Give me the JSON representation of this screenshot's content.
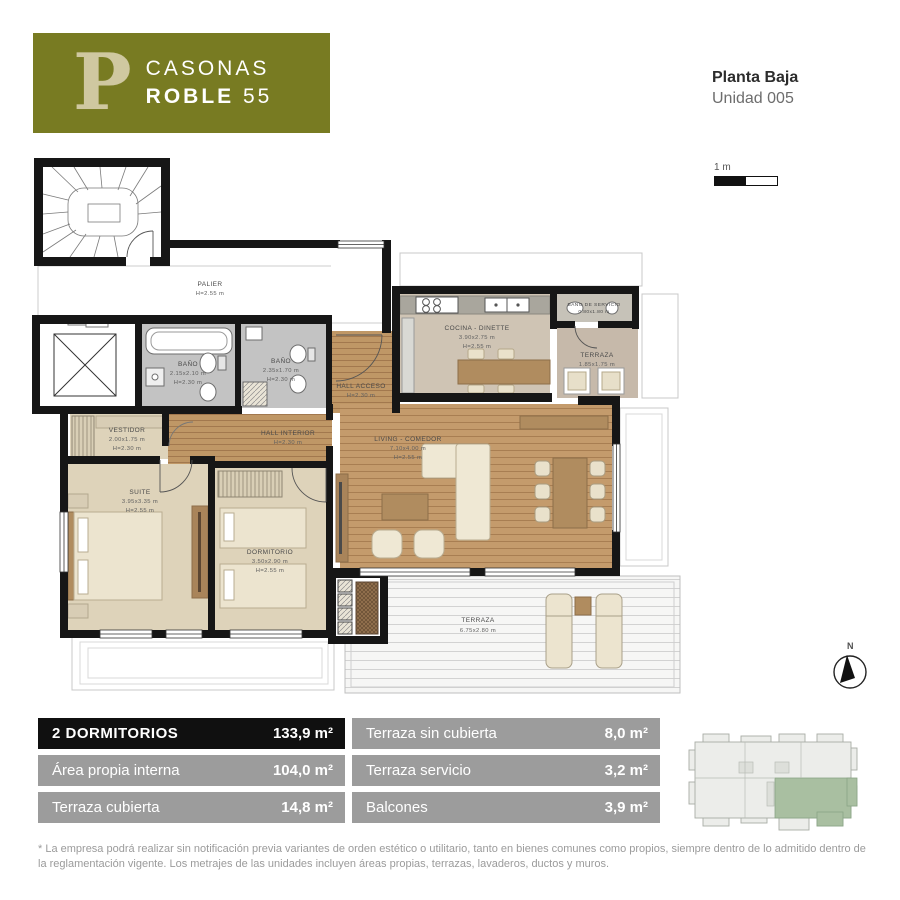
{
  "header": {
    "logo_letter": "P",
    "brand_line1": "CASONAS",
    "brand_bold": "ROBLE",
    "brand_num": "55",
    "plan_title": "Planta Baja",
    "plan_subtitle": "Unidad 005"
  },
  "scale_bar": {
    "label": "1 m"
  },
  "north": {
    "label": "N"
  },
  "floorplan": {
    "rooms": {
      "palier": {
        "name": "PALIER",
        "h": "H=2.55 m"
      },
      "banio1": {
        "name": "BAÑO",
        "dims": "2.15x2.10 m",
        "h": "H=2.30 m"
      },
      "banio2": {
        "name": "BAÑO",
        "dims": "2.35x1.70 m",
        "h": "H=2.30 m"
      },
      "hall_acceso": {
        "name": "HALL ACCESO",
        "h": "H=2.30 m"
      },
      "cocina": {
        "name": "COCINA - DINETTE",
        "dims": "3.90x2.75 m",
        "h": "H=2.55 m"
      },
      "banio_servicio": {
        "name": "BAÑO DE SERVICIO",
        "dims": "0.80x1.80 m"
      },
      "terraza_servicio": {
        "name": "TERRAZA",
        "dims": "1.85x1.75 m"
      },
      "vestidor": {
        "name": "VESTIDOR",
        "dims": "2.00x1.75 m",
        "h": "H=2.30 m"
      },
      "hall_interior": {
        "name": "HALL INTERIOR",
        "h": "H=2.30 m"
      },
      "suite": {
        "name": "SUITE",
        "dims": "3.95x3.35 m",
        "h": "H=2.55 m"
      },
      "dormitorio": {
        "name": "DORMITORIO",
        "dims": "3.50x2.90 m",
        "h": "H=2.55 m"
      },
      "living": {
        "name": "LIVING - COMEDOR",
        "dims": "7.10x4.00 m",
        "h": "H=2.55 m"
      },
      "terraza": {
        "name": "TERRAZA",
        "dims": "6.75x2.80 m"
      }
    }
  },
  "area_table": {
    "left": [
      {
        "label": "2 DORMITORIOS",
        "value": "133,9 m²"
      },
      {
        "label": "Área propia interna",
        "value": "104,0 m²"
      },
      {
        "label": "Terraza cubierta",
        "value": "14,8 m²"
      }
    ],
    "right": [
      {
        "label": "Terraza sin cubierta",
        "value": "8,0 m²"
      },
      {
        "label": "Terraza servicio",
        "value": "3,2 m²"
      },
      {
        "label": "Balcones",
        "value": "3,9 m²"
      }
    ]
  },
  "footnote": "* La empresa podrá realizar sin notificación previa variantes de orden estético o utilitario, tanto en bienes comunes como propios, siempre dentro de lo admitido dentro de la reglamentación vigente. Los metrajes de las unidades incluyen áreas propias, terrazas, lavaderos, ductos y muros.",
  "colors": {
    "brand_olive": "#787b22",
    "logo_letter": "#cfc8a0",
    "table_dark_row": "#101010",
    "table_gray_row": "#9c9c9c",
    "keyplan_unit_green": "#a9bfa1",
    "wood_floor": "#c49b6c",
    "bedroom_floor": "#ded3ba",
    "bath_floor": "#c3c3c3",
    "wall": "#161616"
  }
}
